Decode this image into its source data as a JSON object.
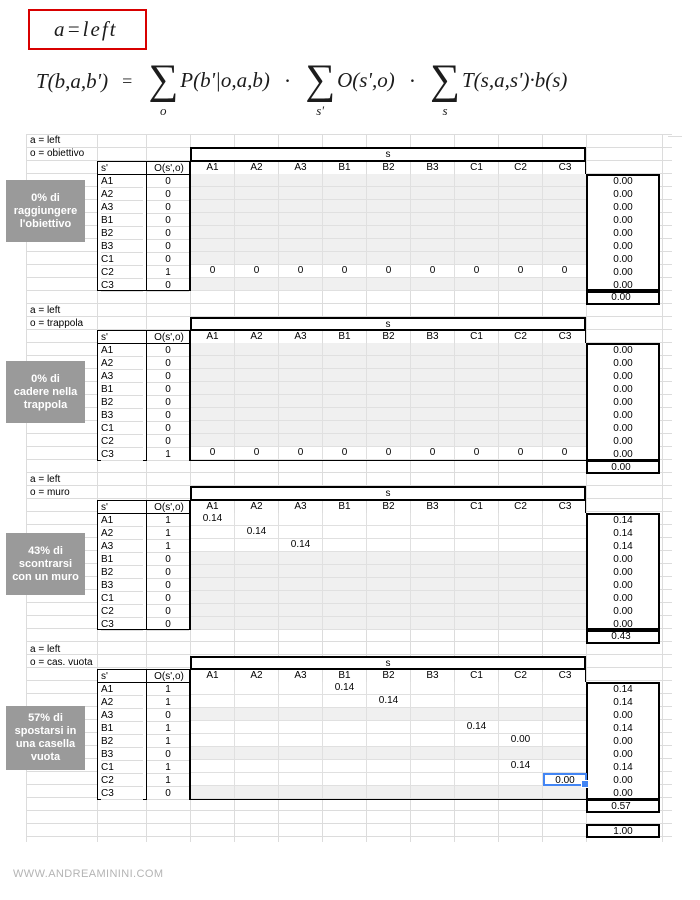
{
  "header": {
    "boxed_label": "a=left",
    "formula": {
      "lhs": "T(b,a,b')",
      "equals": "=",
      "dot": "·",
      "terms": [
        {
          "sigma": "∑",
          "sub": "o",
          "expr": "P(b'|o,a,b)"
        },
        {
          "sigma": "∑",
          "sub": "s'",
          "expr": "O(s',o)"
        },
        {
          "sigma": "∑",
          "sub": "s",
          "expr": "T(s,a,s')·b(s)"
        }
      ]
    }
  },
  "sheet": {
    "s_prime_header": "s'",
    "o_header": "O(s',o)",
    "s_span_label": "s",
    "col_headers": [
      "A1",
      "A2",
      "A3",
      "B1",
      "B2",
      "B3",
      "C1",
      "C2",
      "C3"
    ],
    "sections": [
      {
        "a_label": "a = left",
        "o_label": "o = obiettivo",
        "note_lines": [
          "0% di",
          "raggiungere",
          "l'obiettivo"
        ],
        "sum": "0.00",
        "rows": [
          {
            "s": "A1",
            "o": "0",
            "shaded": true,
            "cells": [
              "",
              "",
              "",
              "",
              "",
              "",
              "",
              "",
              ""
            ],
            "total": "0.00"
          },
          {
            "s": "A2",
            "o": "0",
            "shaded": true,
            "cells": [
              "",
              "",
              "",
              "",
              "",
              "",
              "",
              "",
              ""
            ],
            "total": "0.00"
          },
          {
            "s": "A3",
            "o": "0",
            "shaded": true,
            "cells": [
              "",
              "",
              "",
              "",
              "",
              "",
              "",
              "",
              ""
            ],
            "total": "0.00"
          },
          {
            "s": "B1",
            "o": "0",
            "shaded": true,
            "cells": [
              "",
              "",
              "",
              "",
              "",
              "",
              "",
              "",
              ""
            ],
            "total": "0.00"
          },
          {
            "s": "B2",
            "o": "0",
            "shaded": true,
            "cells": [
              "",
              "",
              "",
              "",
              "",
              "",
              "",
              "",
              ""
            ],
            "total": "0.00"
          },
          {
            "s": "B3",
            "o": "0",
            "shaded": true,
            "cells": [
              "",
              "",
              "",
              "",
              "",
              "",
              "",
              "",
              ""
            ],
            "total": "0.00"
          },
          {
            "s": "C1",
            "o": "0",
            "shaded": true,
            "cells": [
              "",
              "",
              "",
              "",
              "",
              "",
              "",
              "",
              ""
            ],
            "total": "0.00"
          },
          {
            "s": "C2",
            "o": "1",
            "shaded": false,
            "cells": [
              "0",
              "0",
              "0",
              "0",
              "0",
              "0",
              "0",
              "0",
              "0"
            ],
            "total": "0.00"
          },
          {
            "s": "C3",
            "o": "0",
            "shaded": true,
            "cells": [
              "",
              "",
              "",
              "",
              "",
              "",
              "",
              "",
              ""
            ],
            "total": "0.00"
          }
        ]
      },
      {
        "a_label": "a = left",
        "o_label": "o = trappola",
        "note_lines": [
          "0% di",
          "cadere nella",
          "trappola"
        ],
        "sum": "0.00",
        "rows": [
          {
            "s": "A1",
            "o": "0",
            "shaded": true,
            "cells": [
              "",
              "",
              "",
              "",
              "",
              "",
              "",
              "",
              ""
            ],
            "total": "0.00"
          },
          {
            "s": "A2",
            "o": "0",
            "shaded": true,
            "cells": [
              "",
              "",
              "",
              "",
              "",
              "",
              "",
              "",
              ""
            ],
            "total": "0.00"
          },
          {
            "s": "A3",
            "o": "0",
            "shaded": true,
            "cells": [
              "",
              "",
              "",
              "",
              "",
              "",
              "",
              "",
              ""
            ],
            "total": "0.00"
          },
          {
            "s": "B1",
            "o": "0",
            "shaded": true,
            "cells": [
              "",
              "",
              "",
              "",
              "",
              "",
              "",
              "",
              ""
            ],
            "total": "0.00"
          },
          {
            "s": "B2",
            "o": "0",
            "shaded": true,
            "cells": [
              "",
              "",
              "",
              "",
              "",
              "",
              "",
              "",
              ""
            ],
            "total": "0.00"
          },
          {
            "s": "B3",
            "o": "0",
            "shaded": true,
            "cells": [
              "",
              "",
              "",
              "",
              "",
              "",
              "",
              "",
              ""
            ],
            "total": "0.00"
          },
          {
            "s": "C1",
            "o": "0",
            "shaded": true,
            "cells": [
              "",
              "",
              "",
              "",
              "",
              "",
              "",
              "",
              ""
            ],
            "total": "0.00"
          },
          {
            "s": "C2",
            "o": "0",
            "shaded": true,
            "cells": [
              "",
              "",
              "",
              "",
              "",
              "",
              "",
              "",
              ""
            ],
            "total": "0.00"
          },
          {
            "s": "C3",
            "o": "1",
            "shaded": false,
            "cells": [
              "0",
              "0",
              "0",
              "0",
              "0",
              "0",
              "0",
              "0",
              "0"
            ],
            "total": "0.00"
          }
        ]
      },
      {
        "a_label": "a = left",
        "o_label": "o = muro",
        "note_lines": [
          "43% di",
          "scontrarsi",
          "con un muro"
        ],
        "sum": "0.43",
        "rows": [
          {
            "s": "A1",
            "o": "1",
            "shaded": false,
            "cells": [
              "0.14",
              "",
              "",
              "",
              "",
              "",
              "",
              "",
              ""
            ],
            "total": "0.14"
          },
          {
            "s": "A2",
            "o": "1",
            "shaded": false,
            "cells": [
              "",
              "0.14",
              "",
              "",
              "",
              "",
              "",
              "",
              ""
            ],
            "total": "0.14"
          },
          {
            "s": "A3",
            "o": "1",
            "shaded": false,
            "cells": [
              "",
              "",
              "0.14",
              "",
              "",
              "",
              "",
              "",
              ""
            ],
            "total": "0.14"
          },
          {
            "s": "B1",
            "o": "0",
            "shaded": true,
            "cells": [
              "",
              "",
              "",
              "",
              "",
              "",
              "",
              "",
              ""
            ],
            "total": "0.00"
          },
          {
            "s": "B2",
            "o": "0",
            "shaded": true,
            "cells": [
              "",
              "",
              "",
              "",
              "",
              "",
              "",
              "",
              ""
            ],
            "total": "0.00"
          },
          {
            "s": "B3",
            "o": "0",
            "shaded": true,
            "cells": [
              "",
              "",
              "",
              "",
              "",
              "",
              "",
              "",
              ""
            ],
            "total": "0.00"
          },
          {
            "s": "C1",
            "o": "0",
            "shaded": true,
            "cells": [
              "",
              "",
              "",
              "",
              "",
              "",
              "",
              "",
              ""
            ],
            "total": "0.00"
          },
          {
            "s": "C2",
            "o": "0",
            "shaded": true,
            "cells": [
              "",
              "",
              "",
              "",
              "",
              "",
              "",
              "",
              ""
            ],
            "total": "0.00"
          },
          {
            "s": "C3",
            "o": "0",
            "shaded": true,
            "cells": [
              "",
              "",
              "",
              "",
              "",
              "",
              "",
              "",
              ""
            ],
            "total": "0.00"
          }
        ]
      },
      {
        "a_label": "a = left",
        "o_label": "o = cas. vuota",
        "note_lines": [
          "57% di",
          "spostarsi in",
          "una casella",
          "vuota"
        ],
        "sum": "0.57",
        "rows": [
          {
            "s": "A1",
            "o": "1",
            "shaded": false,
            "cells": [
              "",
              "",
              "",
              "0.14",
              "",
              "",
              "",
              "",
              ""
            ],
            "total": "0.14"
          },
          {
            "s": "A2",
            "o": "1",
            "shaded": false,
            "cells": [
              "",
              "",
              "",
              "",
              "0.14",
              "",
              "",
              "",
              ""
            ],
            "total": "0.14"
          },
          {
            "s": "A3",
            "o": "0",
            "shaded": true,
            "cells": [
              "",
              "",
              "",
              "",
              "",
              "",
              "",
              "",
              ""
            ],
            "total": "0.00"
          },
          {
            "s": "B1",
            "o": "1",
            "shaded": false,
            "cells": [
              "",
              "",
              "",
              "",
              "",
              "",
              "0.14",
              "",
              ""
            ],
            "total": "0.14"
          },
          {
            "s": "B2",
            "o": "1",
            "shaded": false,
            "cells": [
              "",
              "",
              "",
              "",
              "",
              "",
              "",
              "0.00",
              ""
            ],
            "total": "0.00"
          },
          {
            "s": "B3",
            "o": "0",
            "shaded": true,
            "cells": [
              "",
              "",
              "",
              "",
              "",
              "",
              "",
              "",
              ""
            ],
            "total": "0.00"
          },
          {
            "s": "C1",
            "o": "1",
            "shaded": false,
            "cells": [
              "",
              "",
              "",
              "",
              "",
              "",
              "",
              "0.14",
              ""
            ],
            "total": "0.14"
          },
          {
            "s": "C2",
            "o": "1",
            "shaded": false,
            "cells": [
              "",
              "",
              "",
              "",
              "",
              "",
              "",
              "",
              "0.00"
            ],
            "total": "0.00",
            "selected_col": 8
          },
          {
            "s": "C3",
            "o": "0",
            "shaded": true,
            "cells": [
              "",
              "",
              "",
              "",
              "",
              "",
              "",
              "",
              ""
            ],
            "total": "0.00"
          }
        ]
      }
    ],
    "grand_total": "1.00"
  },
  "footer": {
    "watermark": "WWW.ANDREAMININI.COM"
  },
  "colors": {
    "accent_red": "#d80000",
    "selection_blue": "#4285f4",
    "note_bg": "#9a9a9a",
    "shaded_cell": "#f0f0f0",
    "gridline": "#dcdcdc"
  }
}
